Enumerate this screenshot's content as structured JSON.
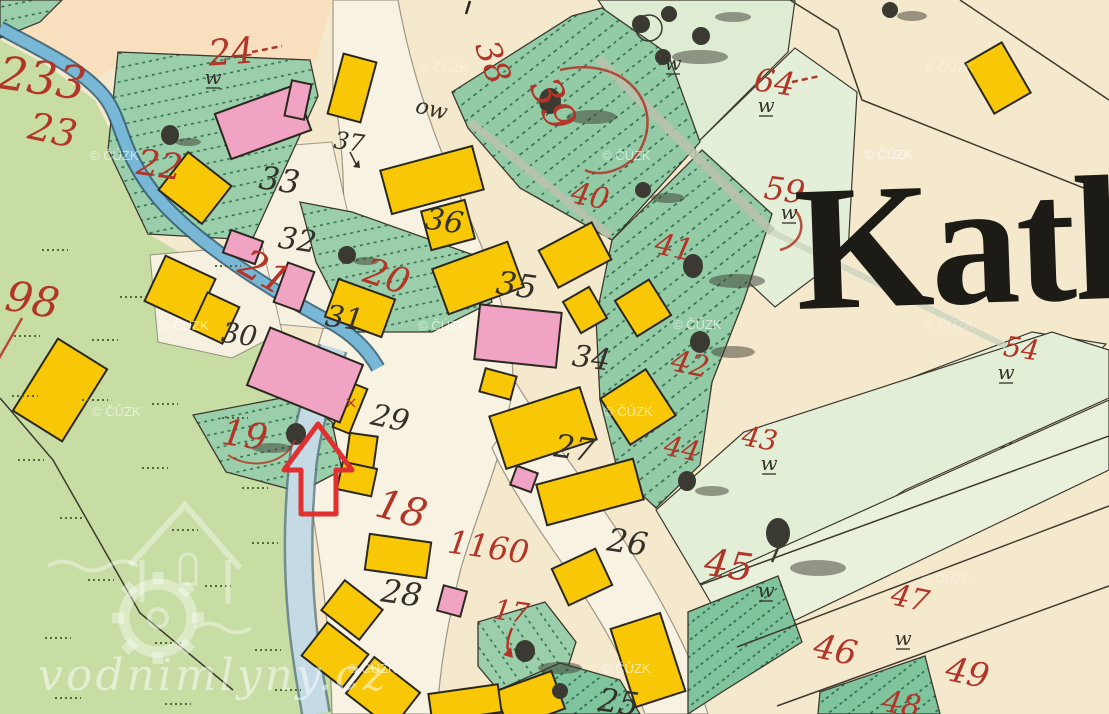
{
  "map": {
    "type": "historical cadastral map crop",
    "title_fragment": "Kath",
    "marker": {
      "shape": "red-outline-arrow-up",
      "color": "#e03030"
    }
  },
  "colors": {
    "parchment": "#f5e9cd",
    "field_cream": "#f8e0bf",
    "meadow_green": "#c7dda4",
    "garden_green": "#9bcfab",
    "pale_green": "#e2eed6",
    "stream_blue": "#79b7d6",
    "pond_blue": "#c4dbe6",
    "building_yellow": "#f8c807",
    "building_pink": "#f0a3c3",
    "parcel_number_red": "#b23527",
    "house_number_black": "#34312a",
    "marker_red": "#e03030"
  },
  "red_numbers": [
    {
      "text": "233"
    },
    {
      "text": "23"
    },
    {
      "text": "24"
    },
    {
      "text": "22"
    },
    {
      "text": "98"
    },
    {
      "text": "21"
    },
    {
      "text": "20"
    },
    {
      "text": "19"
    },
    {
      "text": "18"
    },
    {
      "text": "38"
    },
    {
      "text": "39"
    },
    {
      "text": "40"
    },
    {
      "text": "41"
    },
    {
      "text": "42"
    },
    {
      "text": "44"
    },
    {
      "text": "43"
    },
    {
      "text": "59"
    },
    {
      "text": "64"
    },
    {
      "text": "54"
    },
    {
      "text": "45"
    },
    {
      "text": "47"
    },
    {
      "text": "46"
    },
    {
      "text": "49"
    },
    {
      "text": "48"
    },
    {
      "text": "17"
    },
    {
      "text": "1160"
    }
  ],
  "black_numbers": [
    {
      "text": "33"
    },
    {
      "text": "32"
    },
    {
      "text": "31"
    },
    {
      "text": "30"
    },
    {
      "text": "29"
    },
    {
      "text": "28"
    },
    {
      "text": "27"
    },
    {
      "text": "26"
    },
    {
      "text": "25"
    },
    {
      "text": "35"
    },
    {
      "text": "34"
    },
    {
      "text": "36"
    },
    {
      "text": "37"
    }
  ],
  "symbols": {
    "w": "w",
    "ow": "ow",
    "x_mark": "×"
  },
  "watermark": {
    "copyright": "© ČÚZK",
    "site": "vodnimlyny.cz"
  }
}
